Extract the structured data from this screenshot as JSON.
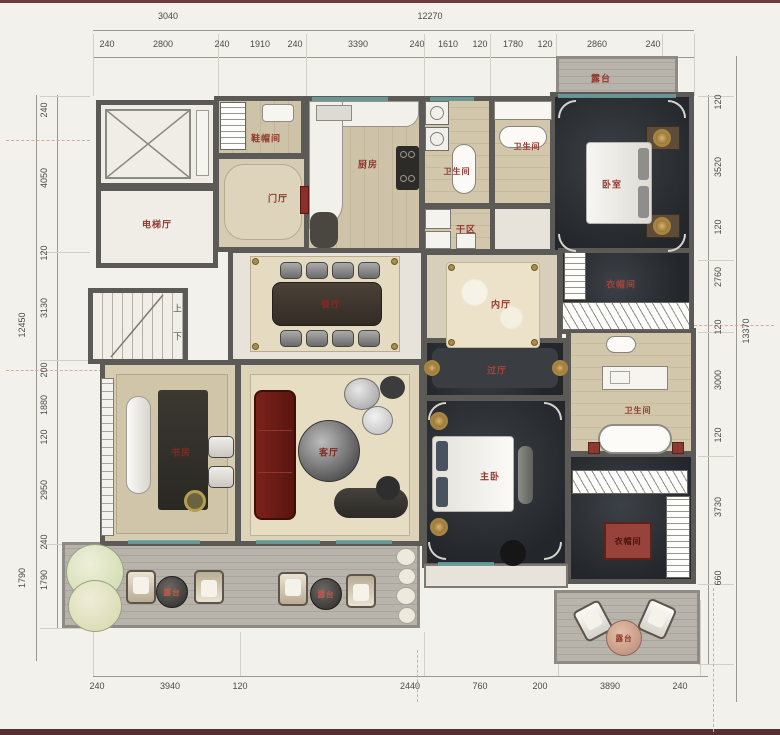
{
  "plan_title": "residential floor plan",
  "dims": {
    "top_overall": [
      "3040",
      "12270"
    ],
    "top": [
      "240",
      "2800",
      "240",
      "1910",
      "240",
      "3390",
      "240",
      "1610",
      "120",
      "1780",
      "120",
      "2860",
      "240"
    ],
    "left_overall": "12450",
    "left_outer_bottom": "1790",
    "left": [
      "240",
      "4050",
      "120",
      "3130",
      "200",
      "1880",
      "120",
      "2950",
      "240",
      "1790"
    ],
    "right_overall": "13370",
    "right": [
      "120",
      "3520",
      "120",
      "2760",
      "120",
      "3000",
      "120",
      "3730",
      "660"
    ],
    "bottom": [
      "240",
      "3940",
      "120",
      "2440",
      "760",
      "200",
      "3890",
      "240"
    ]
  },
  "rooms": {
    "elevator_hall": "电梯厅",
    "shoe_closet": "鞋帽间",
    "foyer": "门厅",
    "kitchen": "厨房",
    "bath1": "卫生间",
    "bath2": "卫生间",
    "dry_area": "干区",
    "dining": "餐厅",
    "inner_hall": "内厅",
    "bedroom2": "卧室",
    "terrace_top": "露台",
    "closet1": "衣帽间",
    "study": "书房",
    "living": "客厅",
    "passage": "过厅",
    "master_bedroom": "主卧",
    "master_bath": "卫生间",
    "closet2": "衣帽间",
    "terrace_b1": "露台",
    "terrace_b2": "露台",
    "terrace_r": "露台"
  },
  "stairs": {
    "up": "上",
    "down": "下"
  },
  "colors": {
    "wall": "#5c5a56",
    "label_red": "#93392e",
    "dark_floor": "#2d3135",
    "frame_maroon": "#6e3c3c"
  }
}
